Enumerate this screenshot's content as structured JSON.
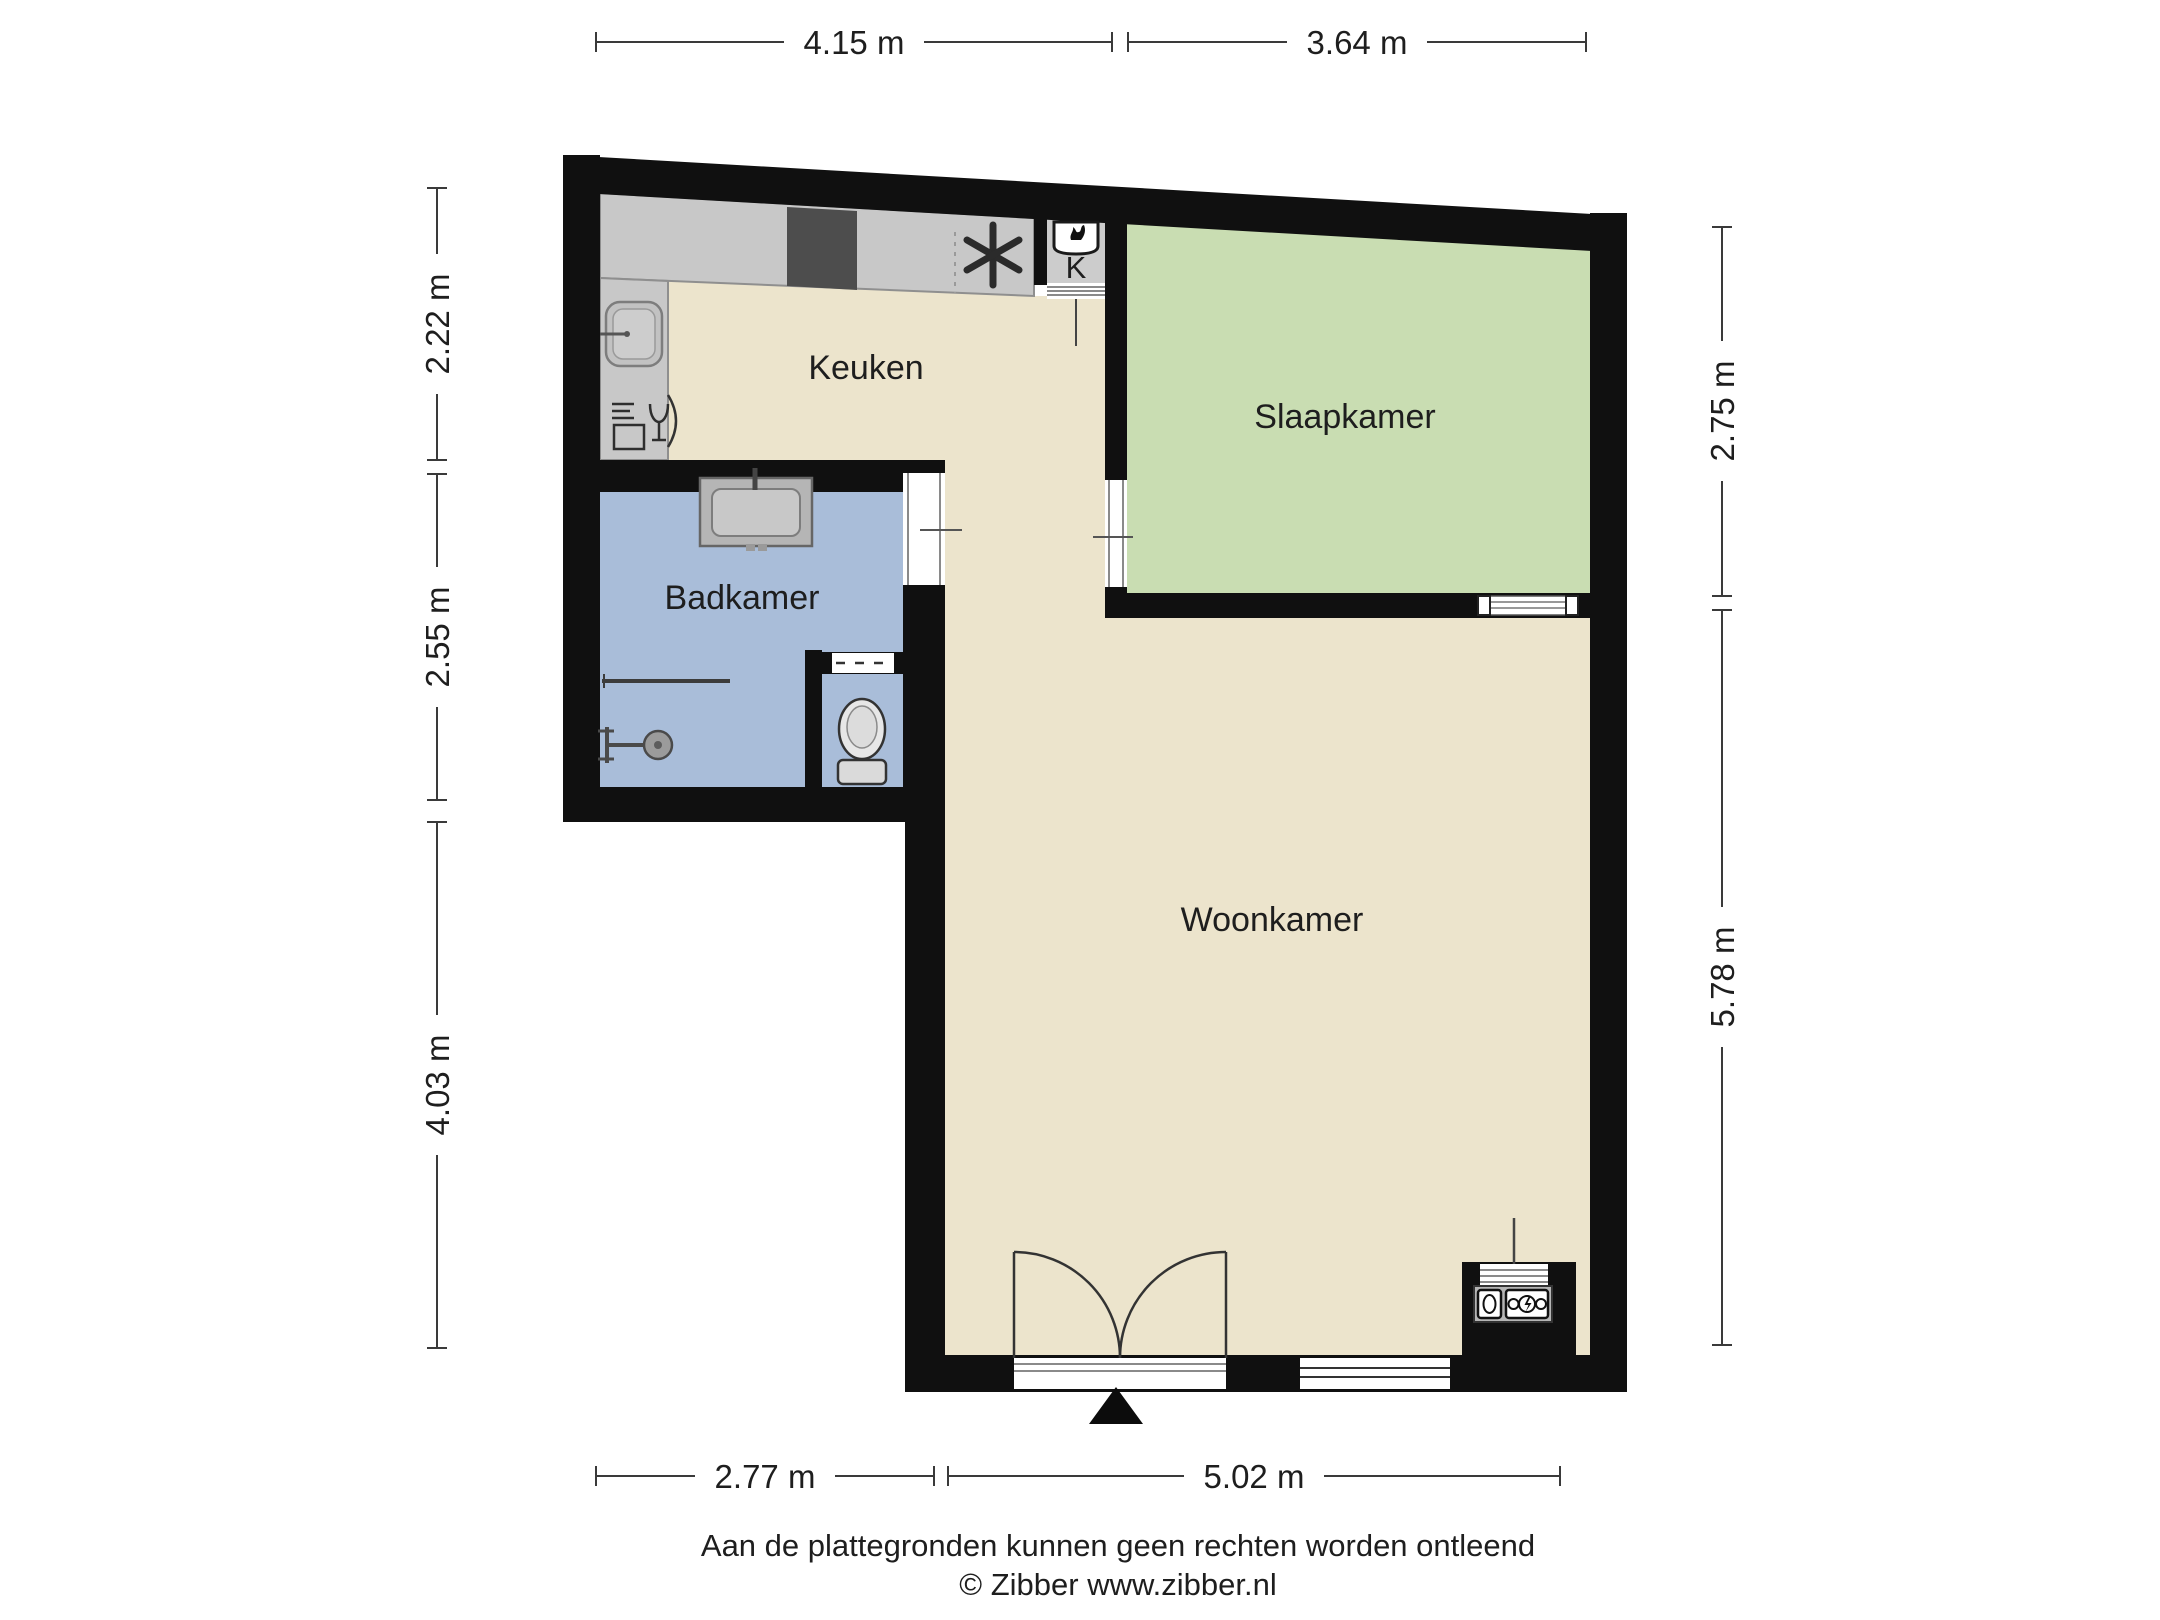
{
  "plan_type": "floorplan",
  "rooms": {
    "kitchen": {
      "label": "Keuken"
    },
    "bedroom": {
      "label": "Slaapkamer"
    },
    "bathroom": {
      "label": "Badkamer"
    },
    "living": {
      "label": "Woonkamer"
    },
    "closet": {
      "label": "K"
    }
  },
  "dimensions": {
    "top": [
      {
        "label": "4.15 m"
      },
      {
        "label": "3.64 m"
      }
    ],
    "left": [
      {
        "label": "2.22 m"
      },
      {
        "label": "2.55 m"
      },
      {
        "label": "4.03 m"
      }
    ],
    "right": [
      {
        "label": "2.75 m"
      },
      {
        "label": "5.78 m"
      }
    ],
    "bottom": [
      {
        "label": "2.77 m"
      },
      {
        "label": "5.02 m"
      }
    ]
  },
  "footer": {
    "disclaimer": "Aan de plattegronden kunnen geen rechten worden ontleend",
    "credit": "© Zibber www.zibber.nl"
  },
  "colors": {
    "wall": "#101010",
    "floor_beige": "#ece4cc",
    "bedroom_green": "#c9ddb2",
    "bathroom_blue": "#a9bdd9",
    "counter_gray": "#c8c8c8",
    "closet_gray": "#cccccc",
    "cooktop_dark": "#4d4d4d",
    "fixture_gray": "#b5b5b5",
    "line_dark": "#333333"
  },
  "icons": {
    "kitchen": [
      "sink-icon",
      "dishwasher-icon",
      "cooktop-icon",
      "freezer-asterisk-icon",
      "boiler-icon"
    ],
    "bathroom": [
      "washbasin-icon",
      "shower-icon",
      "grab-bar-icon",
      "toilet-icon"
    ],
    "living": [
      "double-door-icon",
      "window-icon",
      "water-meter-icon",
      "electricity-meter-icon"
    ],
    "other": [
      "entrance-arrow-icon",
      "sliding-door-icon"
    ]
  }
}
